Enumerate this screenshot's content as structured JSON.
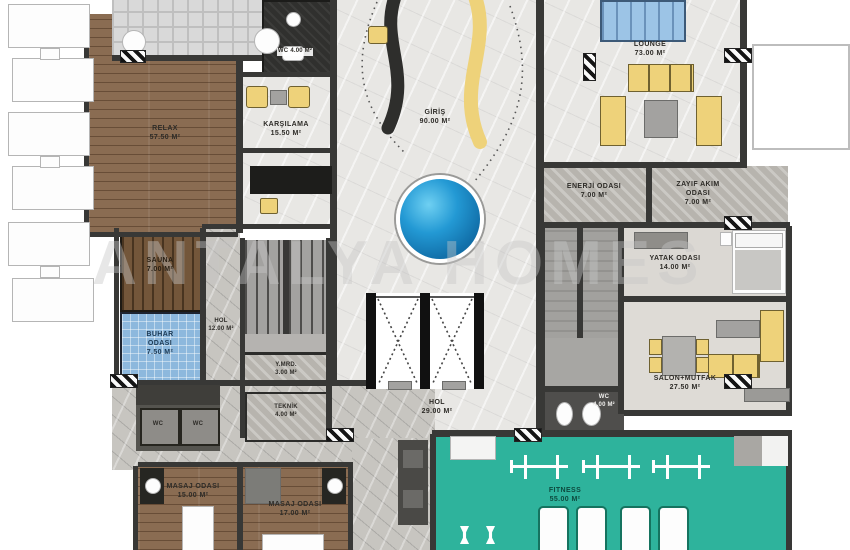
{
  "watermark": "ANTALYA HOMES",
  "colors": {
    "wall": "#383836",
    "marble": "#e8e7e4",
    "corridor": "#c7c5c0",
    "wood": "#8a6c52",
    "sauna-wood": "#73563a",
    "steam-blue": "#8db8dd",
    "pool-blue": "#2399d4",
    "teal": "#2eb39c",
    "furniture-yellow": "#eed27a",
    "gray-room": "#b7b4ae",
    "dark-room": "#30302e",
    "table-gray": "#a3a2a0"
  },
  "rooms": {
    "relax": {
      "name": "RELAX",
      "area": "57.50 M²"
    },
    "karsilama": {
      "name": "KARŞILAMA",
      "area": "15.50 M²"
    },
    "wc_top": {
      "name": "WC",
      "area": "4.00 M²"
    },
    "giris": {
      "name": "GİRİŞ",
      "area": "90.00 M²"
    },
    "lounge": {
      "name": "LOUNGE",
      "area": "73.00 M²"
    },
    "enerji": {
      "name": "ENERJİ ODASI",
      "area": "7.00 M²"
    },
    "zayif_akim": {
      "name": "ZAYIF AKIM ODASI",
      "area": "7.00 M²"
    },
    "yatak": {
      "name": "YATAK ODASI",
      "area": "14.00 M²"
    },
    "salon_mutfak": {
      "name": "SALON+MUTFAK",
      "area": "27.50 M²"
    },
    "sauna": {
      "name": "SAUNA",
      "area": "7.00 M²"
    },
    "buhar": {
      "name": "BUHAR ODASI",
      "area": "7.50 M²"
    },
    "hol_spa": {
      "name": "HOL",
      "area": "12.00 M²"
    },
    "y_mrd": {
      "name": "Y.MRD.",
      "area": "3.00 M²"
    },
    "teknik": {
      "name": "TEKNİK",
      "area": "4.00 M²"
    },
    "hol_asansor": {
      "name": "HOL",
      "area": "29.00 M²"
    },
    "wc_alt": {
      "name": "WC",
      "area": "4.00 M²"
    },
    "fitness": {
      "name": "FITNESS",
      "area": "55.00 M²"
    },
    "masaj_1": {
      "name": "MASAJ ODASI",
      "area": "15.00 M²"
    },
    "masaj_2": {
      "name": "MASAJ ODASI",
      "area": "17.00 M²"
    },
    "wc_stall_1": {
      "name": "WC"
    },
    "wc_stall_2": {
      "name": "WC"
    }
  }
}
